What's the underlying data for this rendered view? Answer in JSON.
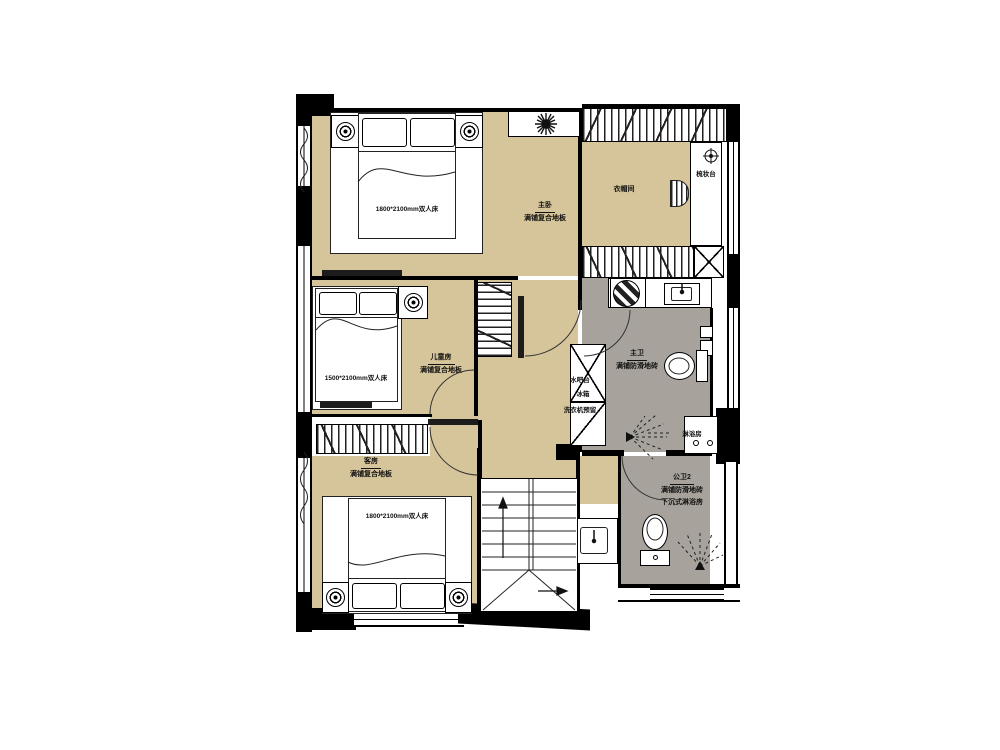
{
  "colors": {
    "floor_wood": "#d6c49a",
    "floor_tile": "#a7a39c",
    "wall": "#000000"
  },
  "rooms": {
    "master": {
      "name": "主卧",
      "floor": "满铺复合地板",
      "bed": "1800*2100mm双人床"
    },
    "closet": {
      "name": "衣帽间",
      "vanity": "梳妆台"
    },
    "kids": {
      "name": "儿童房",
      "floor": "满铺复合地板",
      "bed": "1500*2100mm双人床"
    },
    "mbath": {
      "name": "主卫",
      "floor": "满铺防滑地砖",
      "shower": "淋浴房"
    },
    "utility": {
      "bar": "水吧台",
      "fridge": "冰箱",
      "washer": "洗衣机预留"
    },
    "guest": {
      "name": "客房",
      "floor": "满铺复合地板",
      "bed": "1800*2100mm双人床"
    },
    "bath2": {
      "name": "公卫2",
      "floor": "满铺防滑地砖",
      "note": "下沉式淋浴房"
    }
  }
}
